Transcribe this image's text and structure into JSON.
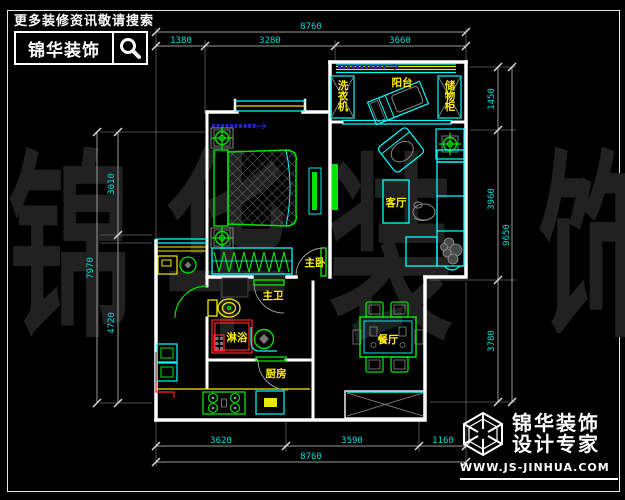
{
  "brand": {
    "tagline": "更多装修资讯敬请搜索",
    "name": "锦华装饰",
    "subtitle": "设计专家",
    "url": "WWW.JS-JINHUA.COM"
  },
  "watermark": [
    "锦",
    "华",
    "装",
    "饰"
  ],
  "rooms": {
    "balcony": "阳台",
    "living": "客厅",
    "bedroom": "主卧",
    "bathroom": "主卫",
    "shower": "淋浴",
    "kitchen": "厨房",
    "dining": "餐厅",
    "balcony_cabinet_left": "洗衣机",
    "balcony_cabinet_right": "储物柜"
  },
  "dimensions": {
    "top": {
      "overall": "8760",
      "segs": [
        "1380",
        "3280",
        "3660"
      ]
    },
    "bottom": {
      "overall": "8760",
      "segs": [
        "3620",
        "3590",
        "1160"
      ]
    },
    "left": {
      "overall": "7970",
      "segs": [
        "3010",
        "4720"
      ]
    },
    "right": {
      "overall": "9650",
      "segs": [
        "1450",
        "3960",
        "3780"
      ]
    }
  },
  "colors": {
    "background": "#000000",
    "wall": "#ffffff",
    "window_cyan": "#00ffff",
    "furniture_green": "#00e400",
    "label_yellow": "#ffee00",
    "shower_red": "#ff2222",
    "dim_text_cyan": "#00d9d9",
    "annotation_blue": "#2222cc",
    "watermark_gray": "#212121"
  }
}
